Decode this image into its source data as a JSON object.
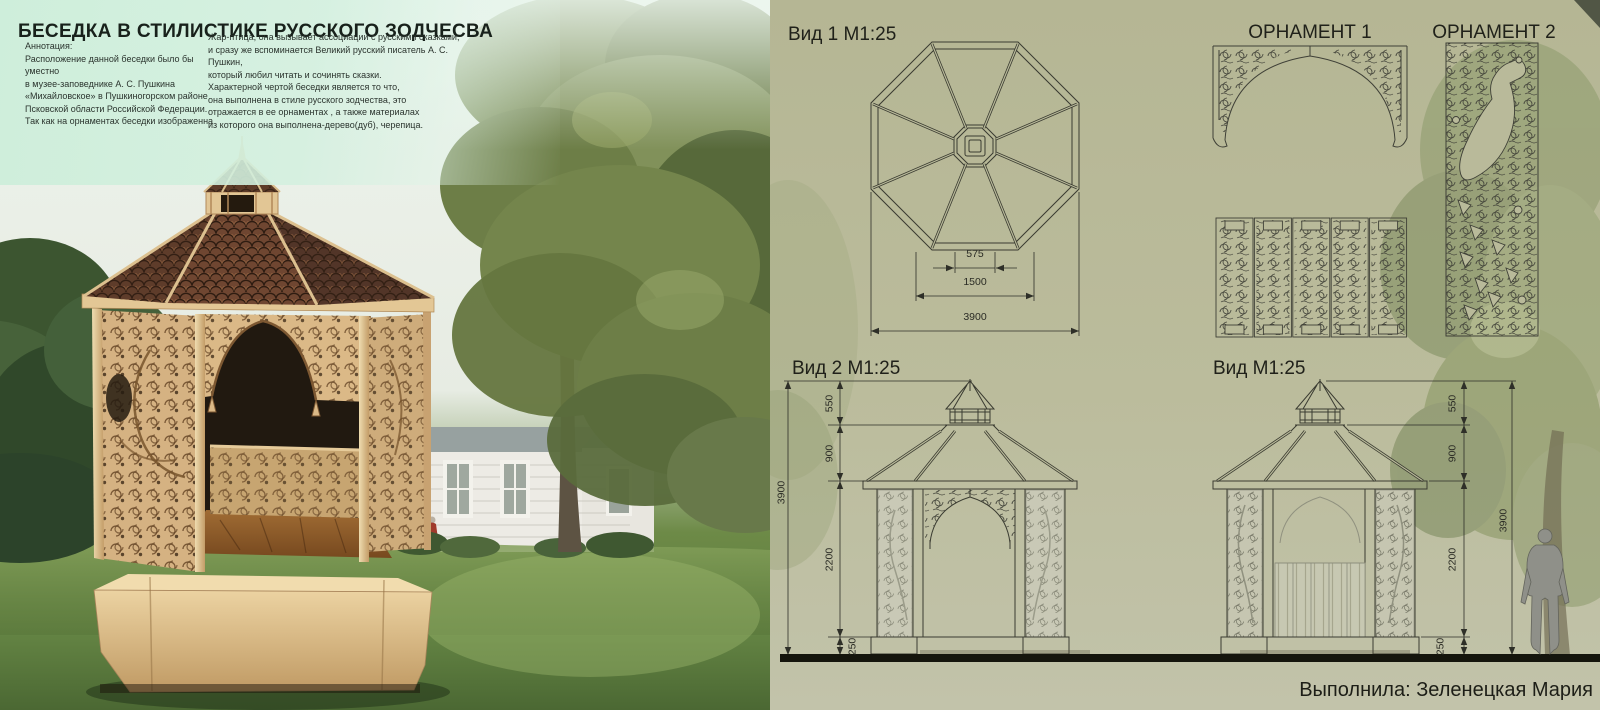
{
  "header": {
    "title": "БЕСЕДКА В СТИЛИСТИКЕ РУССКОГО ЗОДЧЕСВА",
    "annotation_left": "Аннотация:\nРасположение данной беседки было бы уместно\nв  музее-заповеднике А. С. Пушкина\n«Михайловское» в Пушкиногорском районе\n Псковской области Российской Федерации.\nТак как на орнаментах беседки изображенна",
    "annotation_right": "Жар-птица, она вызывает ассоциации с русскими сказками,\nи сразу же вспоминается Великий русский писатель А. С. Пушкин,\nкоторый любил читать и сочинять сказки.\nХарактерной чертой беседки является то что,\nона выполнена в стиле русского зодчества, это\nотражается в ее орнаментах , а также материалах\nиз которого она выполнена-дерево(дуб), черепица."
  },
  "drawings": {
    "top_view": {
      "label": "Вид 1 М1:25",
      "dim_lantern": "575",
      "dim_inner": "1500",
      "dim_total": "3900"
    },
    "ornament1": {
      "label": "ОРНАМЕНТ 1"
    },
    "ornament2": {
      "label": "ОРНАМЕНТ 2"
    },
    "front_view": {
      "label": "Вид 2 М1:25",
      "dim_cupola": "550",
      "dim_roof": "900",
      "dim_wall": "2200",
      "dim_base": "250",
      "dim_total": "3900"
    },
    "side_view": {
      "label": "Вид  М1:25",
      "dim_cupola": "550",
      "dim_roof": "900",
      "dim_wall": "2200",
      "dim_base": "250",
      "dim_total": "3900"
    }
  },
  "footer": {
    "credit": "Выполнила: Зеленецкая Мария"
  },
  "colors": {
    "board_bg": "#b9ba9a",
    "drawing_ink": "#3a3b31",
    "ground_line": "#15150d",
    "title_mint": "#cdeeda",
    "gazebo_wood": "#d5b282",
    "roof_shingle": "#6f4631",
    "lawn_green": "#6d8a47",
    "figure_gray": "#8f9089"
  }
}
